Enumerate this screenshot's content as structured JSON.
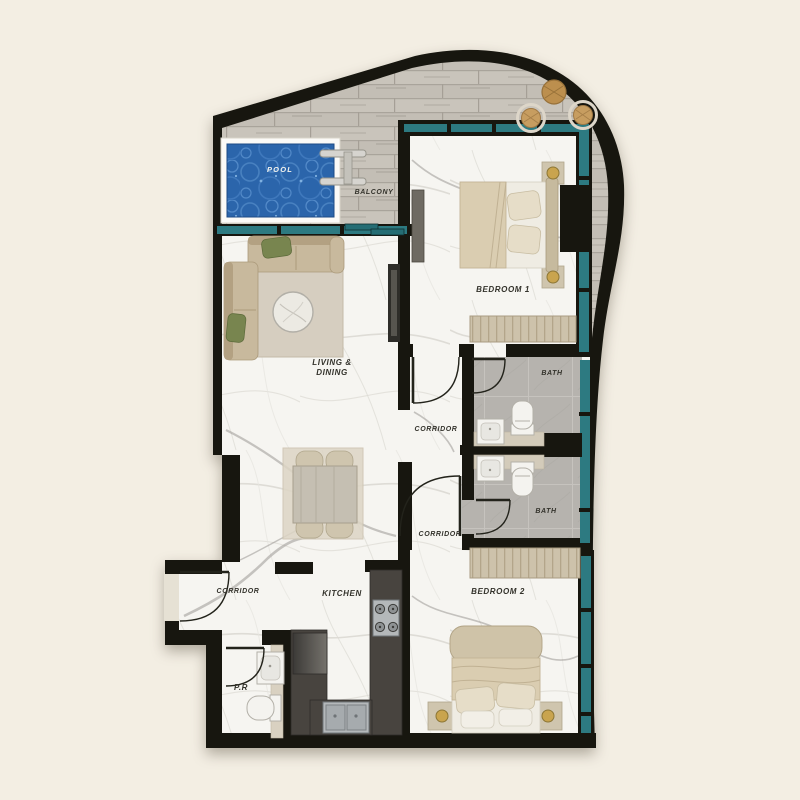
{
  "labels": {
    "pool": "POOL",
    "balcony": "BALCONY",
    "bedroom1": "BEDROOM 1",
    "living_line1": "LIVING &",
    "living_line2": "DINING",
    "corridor_main": "CORRIDOR",
    "bath_top": "BATH",
    "bath_bottom": "BATH",
    "corridor_south": "CORRIDOR",
    "bedroom2": "BEDROOM 2",
    "kitchen": "KITCHEN",
    "corridor_entry": "CORRIDOR",
    "powder_room": "P.R"
  },
  "colors": {
    "background": "#f3eee3",
    "walls": "#17160f",
    "window_glass": "#2d7a81",
    "pool_water": "#2b65ab",
    "pool_ripple": "#4e86c5",
    "marble_floor": "#f6f5f1",
    "deck_wood": "#c9c4bb",
    "bath_tile": "#b6b3ae",
    "furniture_beige": "#c8b99d",
    "accent_green": "#78854f",
    "counter_dark": "#48443f",
    "wood_furniture": "#c2975a",
    "gold_lamp": "#c9a44e"
  }
}
